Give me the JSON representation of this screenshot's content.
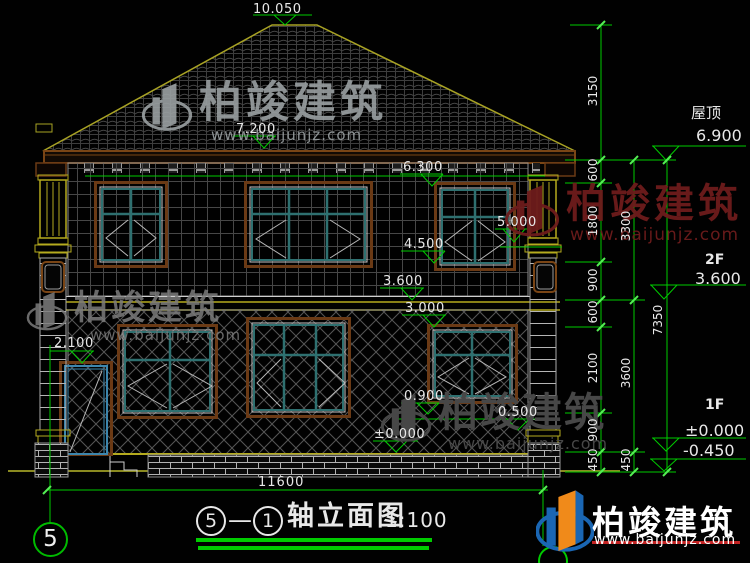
{
  "drawing": {
    "title": {
      "axis_start": "5",
      "dash": "—",
      "axis_end": "1",
      "name": "轴立面图",
      "scale": "1:100"
    },
    "axis_bubble_left": "5",
    "levels": {
      "roof_label": "屋顶",
      "roof_elev": "6.900",
      "f2_label": "2F",
      "f2_elev": "3.600",
      "f1_label": "1F",
      "f1_elev": "±0.000",
      "ground_elev": "-0.450"
    },
    "spot_elevations": [
      "10.050",
      "7.200",
      "6.300",
      "5.000",
      "4.500",
      "3.600",
      "3.000",
      "2.100",
      "0.900",
      "0.500",
      "±0.000"
    ],
    "dims": {
      "chain_inner": [
        "3150",
        "600",
        "1800",
        "900",
        "600",
        "2100",
        "900",
        "450"
      ],
      "chain_mid": [
        "3300",
        "3600",
        "450"
      ],
      "chain_outer": [
        "7350"
      ],
      "total_width": "11600"
    },
    "watermark": {
      "brand": "柏竣建筑",
      "url": "www.baijunjz.com"
    },
    "footer_brand": {
      "name": "柏竣建筑",
      "url": "www.baijunjz.com"
    },
    "colors": {
      "dimension_green": "#00cc00",
      "outline_yellow": "#b5ab1e",
      "frame_brown": "#6b3a15",
      "window_teal": "#2e7070",
      "door_cyan": "#3d86ad",
      "brand_blue": "#1a66b3",
      "brand_orange": "#f08a1a"
    }
  }
}
